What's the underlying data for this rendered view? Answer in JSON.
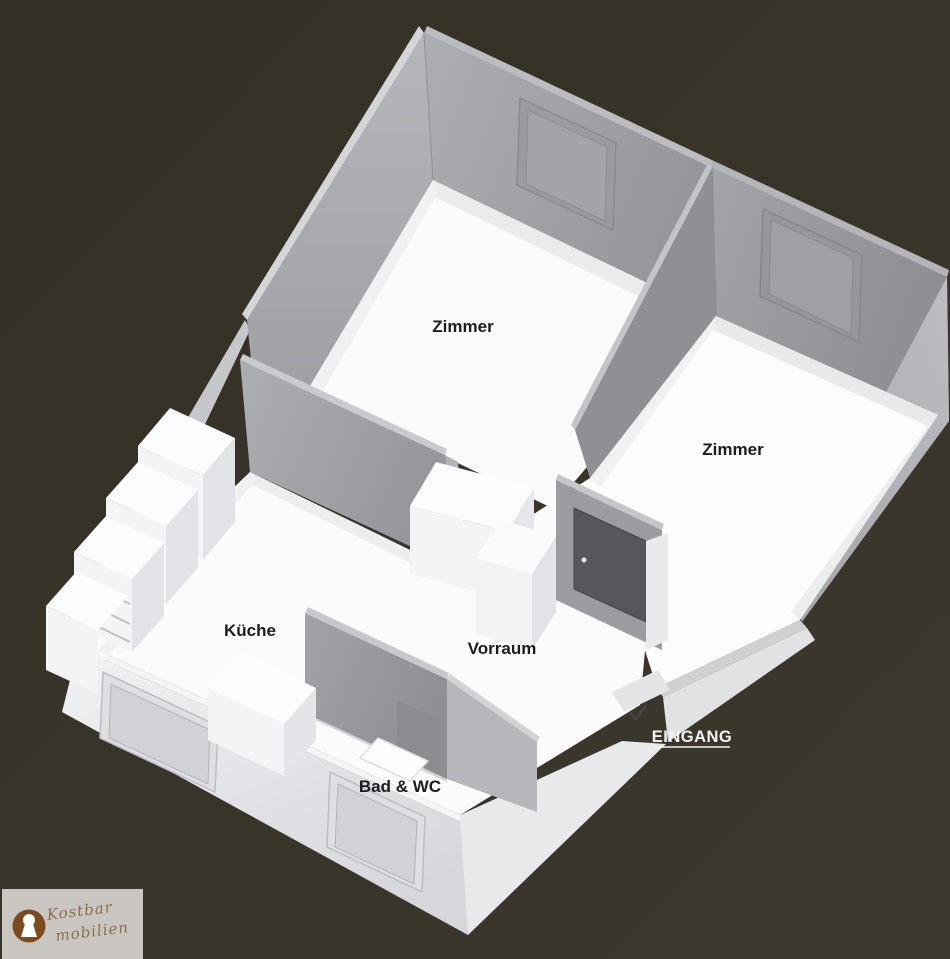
{
  "scene": {
    "type": "3d-floorplan",
    "background_color": "#373328",
    "floor_color": "#fbfbfc",
    "wall_gray": "#a0a1a4",
    "outer_wall_color": "#e7e9eb",
    "door_color": "#56575b",
    "label_color": "#1c1c1e",
    "entrance_label_color": "#f4f4f4"
  },
  "labels": {
    "room1": "Zimmer",
    "room2": "Zimmer",
    "kitchen": "Küche",
    "hallway": "Vorraum",
    "bathroom": "Bad & WC",
    "entrance": "EINGANG"
  },
  "logo": {
    "line1": "Kostbar",
    "line2": "mobilien",
    "badge_color": "#7b4a1f",
    "box_color": "#c9c6c2",
    "text_color": "#8f6c49",
    "icon": "keyhole-icon"
  }
}
